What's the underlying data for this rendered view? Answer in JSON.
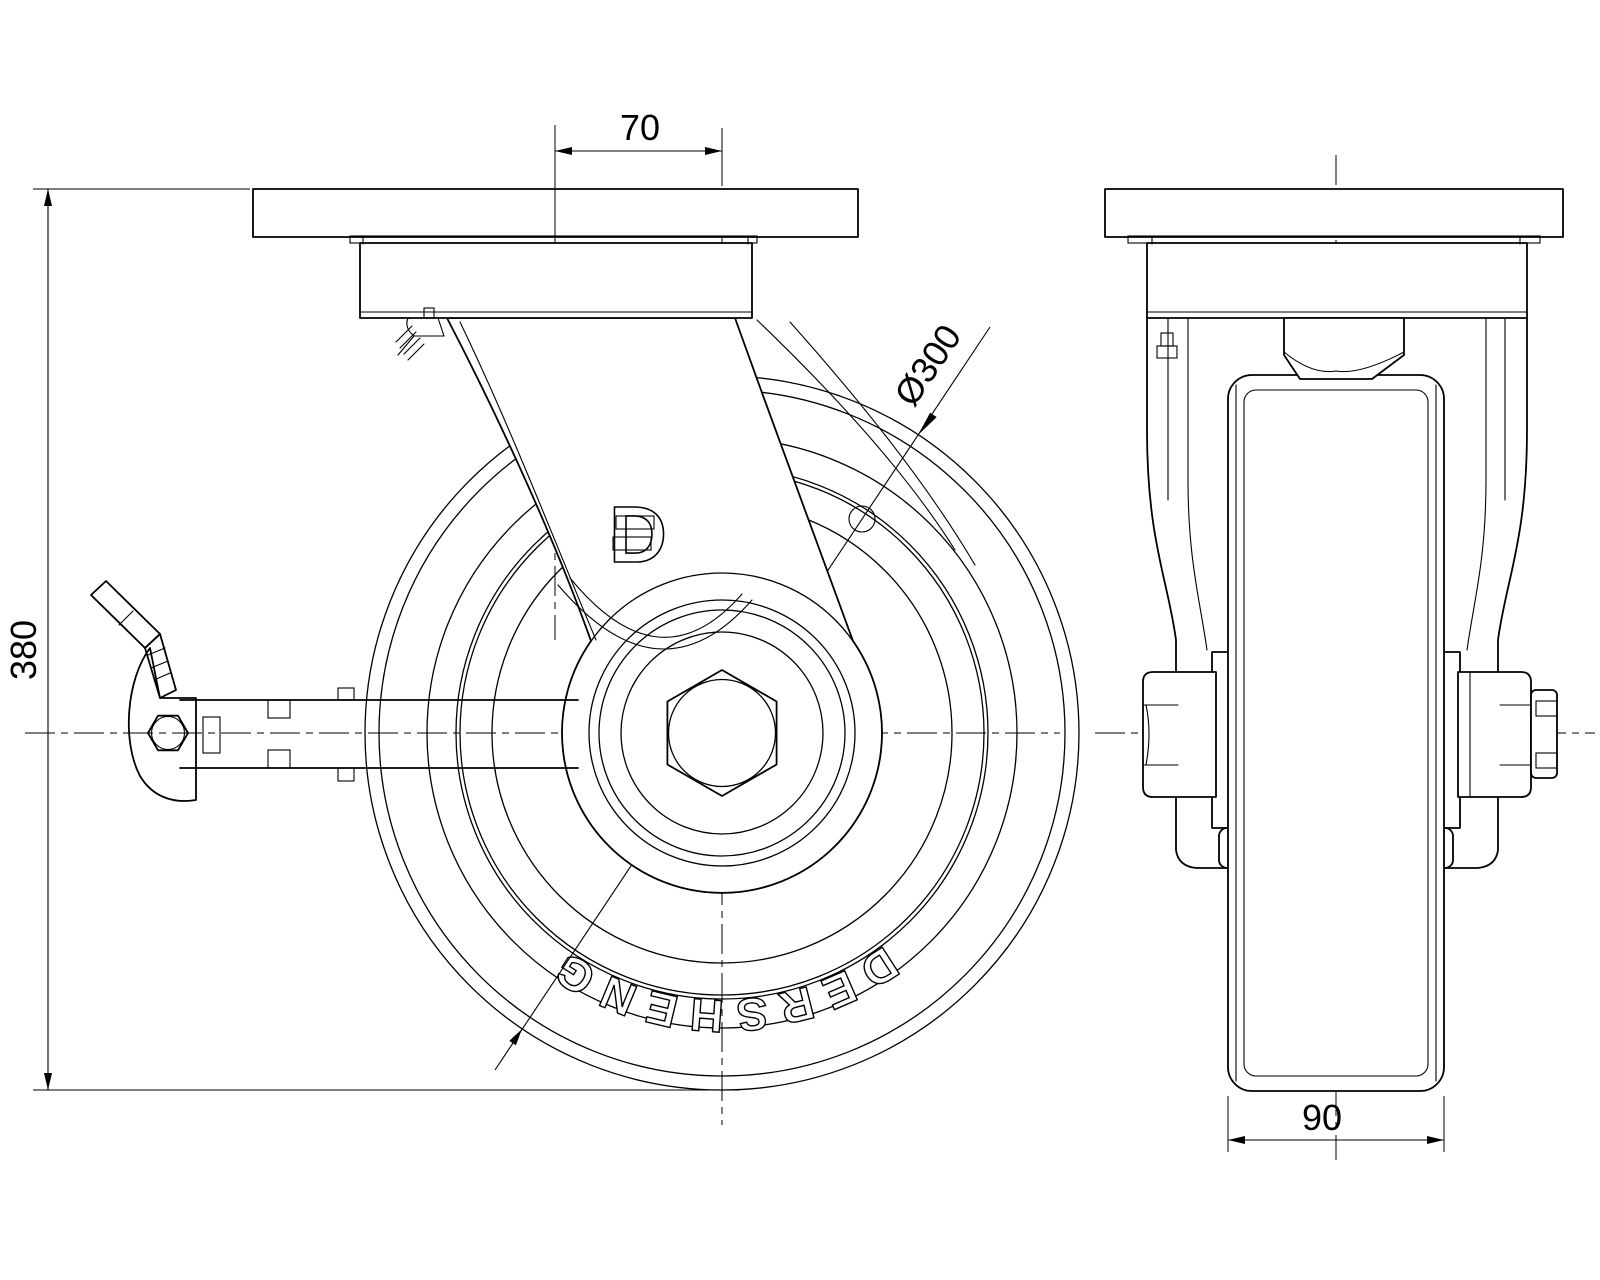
{
  "drawing": {
    "type": "caster-wheel-technical-drawing",
    "views": {
      "left": "side-view-swivel-caster-with-brake",
      "right": "front-view"
    }
  },
  "dimensions": {
    "top_offset": "70",
    "overall_height": "380",
    "wheel_diameter": "Ø300",
    "wheel_width": "90"
  },
  "brand": {
    "wheel_text": "DERSHENG",
    "logo_letter": "D"
  },
  "colors": {
    "line": "#000000",
    "background": "#ffffff"
  }
}
